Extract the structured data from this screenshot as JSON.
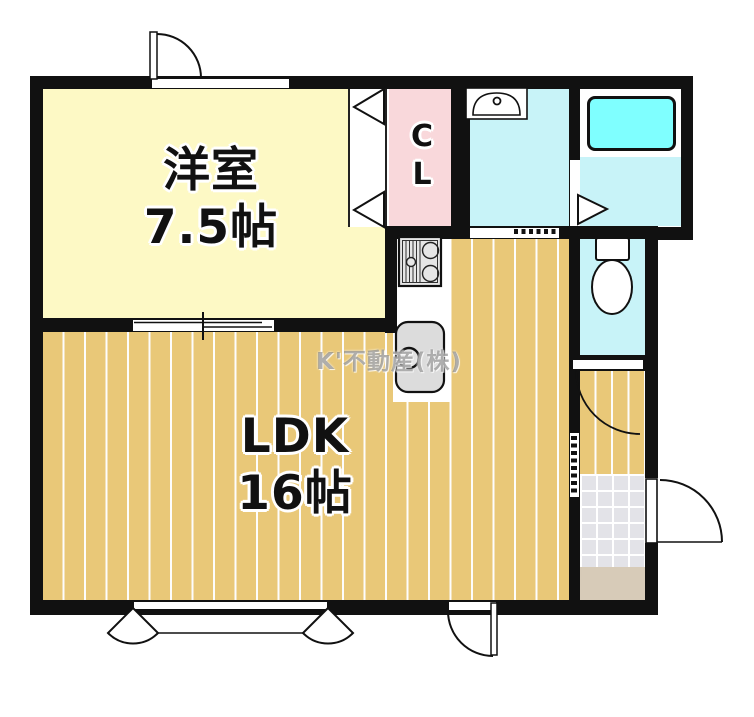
{
  "watermark": "K'不動産(株)",
  "rooms": {
    "western": {
      "name": "洋室",
      "size": "7.5帖"
    },
    "ldk": {
      "name": "LDK",
      "size": "16帖"
    },
    "closet": {
      "char1": "C",
      "char2": "L"
    }
  },
  "fixtures": [
    "bathtub",
    "vanity-sink",
    "toilet",
    "gas-stove",
    "kitchen-sink",
    "entry-door",
    "closet-folding-door",
    "bathroom-door",
    "toilet-door",
    "front-door",
    "sliding-door",
    "accordion-doors",
    "double-swing-door"
  ],
  "colors": {
    "wall": "#111111",
    "western_floor": "#fdf9c5",
    "wood_floor": "#e9c878",
    "closet_pink": "#f9d8db",
    "wet_area_cyan": "#c8f3f8",
    "bathtub_cyan": "#7fffff",
    "tile_gray": "#e3e3e8",
    "step_beige": "#d7cbb8"
  }
}
